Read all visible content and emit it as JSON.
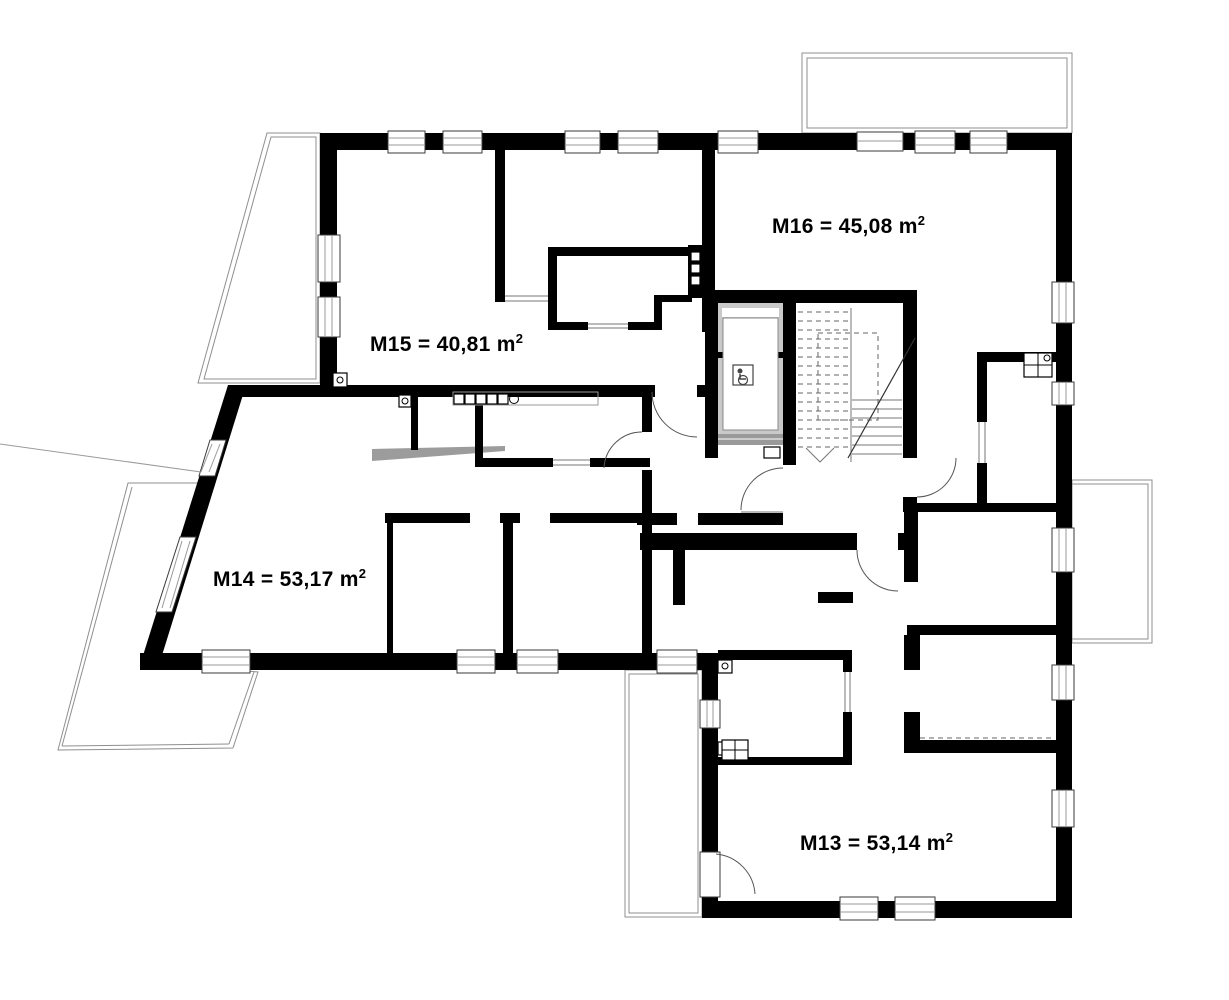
{
  "page": {
    "background": "#ffffff",
    "wall_color": "#000000",
    "balcony_line_color": "#8f8f8f",
    "drawing_type": "apartment floor plan"
  },
  "apartments": [
    {
      "id": "M13",
      "label": "M13 = 53,14 m",
      "sup": "2",
      "area_m2": "53,14"
    },
    {
      "id": "M14",
      "label": "M14 = 53,17 m",
      "sup": "2",
      "area_m2": "53,17"
    },
    {
      "id": "M15",
      "label": "M15 = 40,81 m",
      "sup": "2",
      "area_m2": "40,81"
    },
    {
      "id": "M16",
      "label": "M16 = 45,08 m",
      "sup": "2",
      "area_m2": "45,08"
    }
  ],
  "features": {
    "elevator_symbol": "wheelchair",
    "staircase": "two flights, lower solid, upper dashed, down arrow",
    "balconies": "top-left trapezoid, top-right, right side, bottom-center, large left terrace"
  }
}
